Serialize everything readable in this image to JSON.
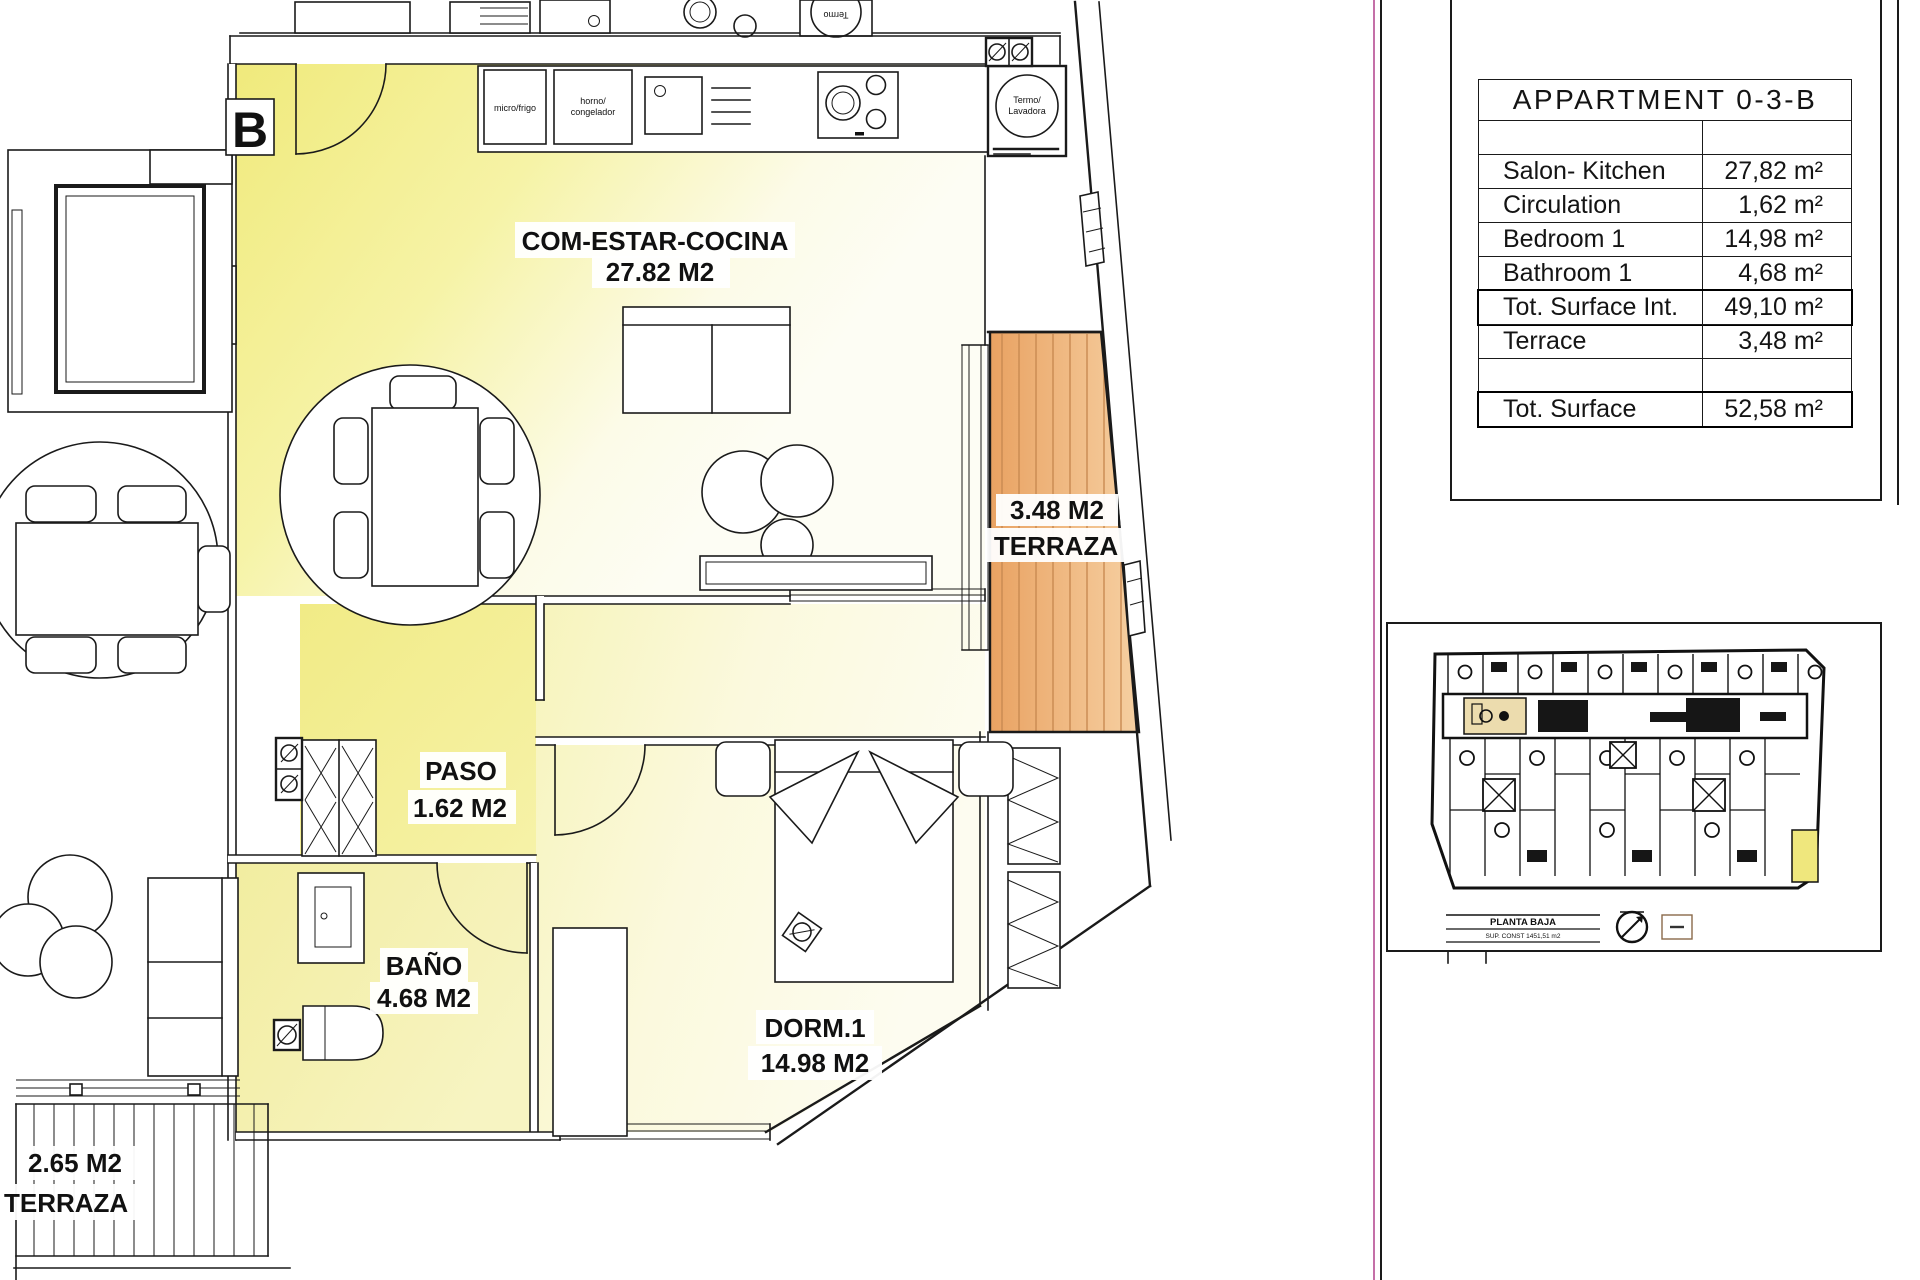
{
  "plan": {
    "block_label": "B",
    "rooms": {
      "living": {
        "name": "COM-ESTAR-COCINA",
        "area": "27.82 M2"
      },
      "paso": {
        "name": "PASO",
        "area": "1.62 M2"
      },
      "bath": {
        "name": "BAÑO",
        "area": "4.68 M2"
      },
      "bedroom": {
        "name": "DORM.1",
        "area": "14.98 M2"
      },
      "terrace": {
        "area": "3.48 M2",
        "name": "TERRAZA"
      },
      "neighbor_terrace": {
        "area": "2.65 M2",
        "name": "TERRAZA"
      }
    },
    "kitchen": {
      "micro": "micro/frigo",
      "oven_line1": "horno/",
      "oven_line2": "congelador",
      "termo_line1": "Termo/",
      "termo_line2": "Lavadora",
      "neighbor_termo": "Termo"
    }
  },
  "area_table": {
    "title": "APPARTMENT 0-3-B",
    "rows": [
      {
        "label": "",
        "value": ""
      },
      {
        "label": "Salon- Kitchen",
        "value": "27,82 m²"
      },
      {
        "label": "Circulation",
        "value": "1,62 m²"
      },
      {
        "label": "Bedroom 1",
        "value": "14,98 m²"
      },
      {
        "label": "Bathroom 1",
        "value": "4,68 m²"
      },
      {
        "label": "Tot. Surface Int.",
        "value": "49,10 m²"
      },
      {
        "label": "Terrace",
        "value": "3,48 m²"
      },
      {
        "label": "",
        "value": ""
      },
      {
        "label": "Tot. Surface",
        "value": "52,58 m²"
      }
    ]
  },
  "site_panel": {
    "legend_title": "PLANTA BAJA",
    "legend_subtitle": "SUP. CONST 1451,51 m2"
  },
  "colors": {
    "room_yellow": "#f0ea7c",
    "room_pale": "#f6f3b4",
    "terrace_orange": "#e9a262",
    "highlight_beige": "#ecdcae",
    "highlight_yellow": "#efe77d",
    "frame_magenta": "#c470a8"
  }
}
